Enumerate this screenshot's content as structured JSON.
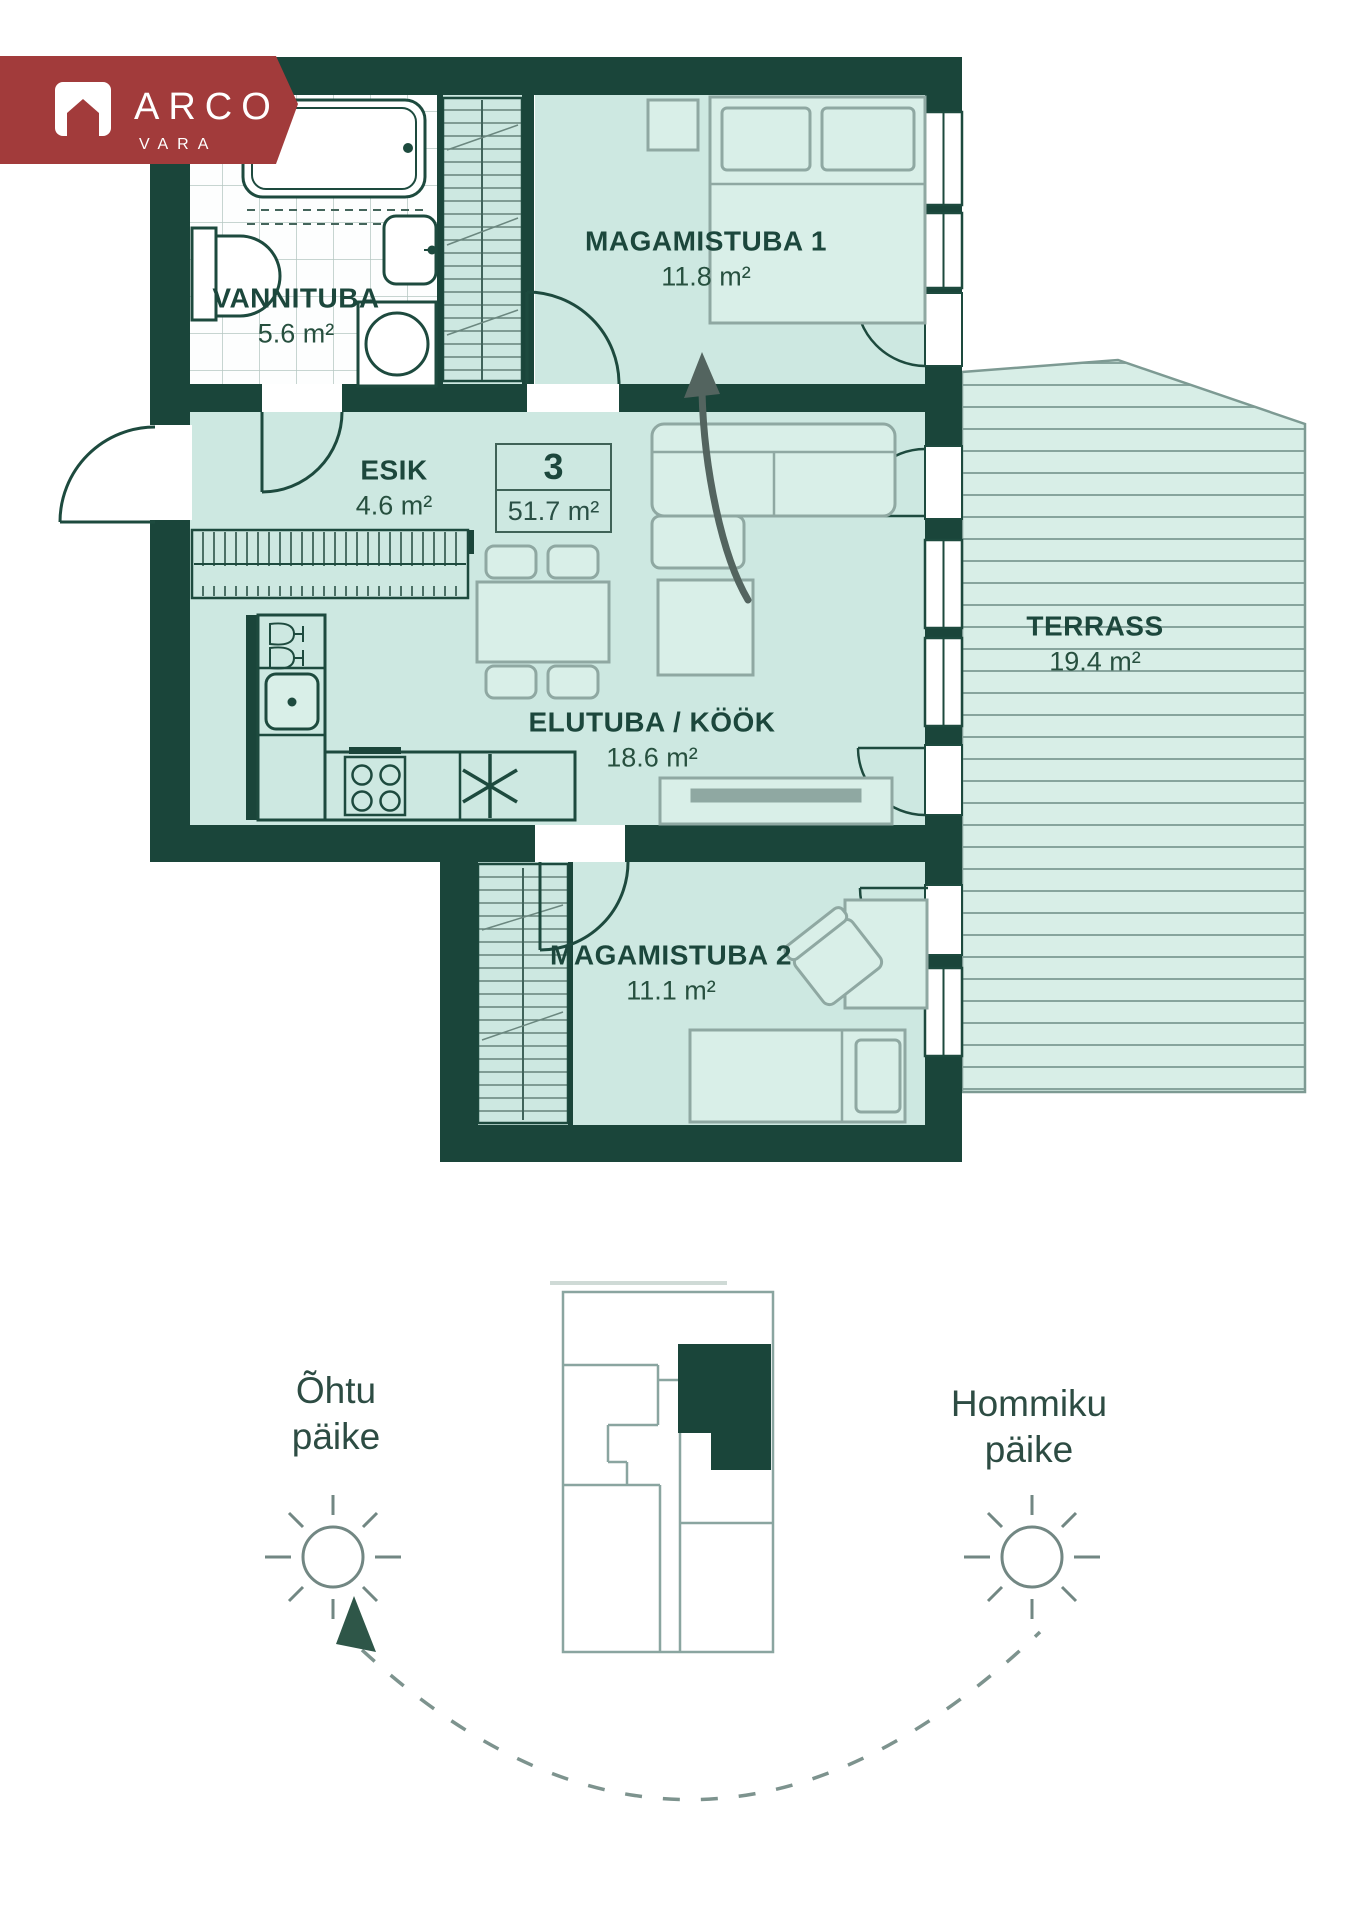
{
  "logo": {
    "brand": "ARCO",
    "sub": "VARA"
  },
  "plan": {
    "unit": {
      "number": "3",
      "area": "51.7 m²"
    },
    "rooms": [
      {
        "id": "vannituba",
        "label": "VANNITUBA",
        "area": "5.6 m²"
      },
      {
        "id": "magamistuba1",
        "label": "MAGAMISTUBA 1",
        "area": "11.8 m²"
      },
      {
        "id": "esik",
        "label": "ESIK",
        "area": "4.6 m²"
      },
      {
        "id": "elutuba_kook",
        "label": "ELUTUBA / KÖÖK",
        "area": "18.6 m²"
      },
      {
        "id": "terrass",
        "label": "TERRASS",
        "area": "19.4 m²"
      },
      {
        "id": "magamistuba2",
        "label": "MAGAMISTUBA 2",
        "area": "11.1 m²"
      }
    ]
  },
  "orientation": {
    "west": {
      "line1": "Õhtu",
      "line2": "päike"
    },
    "east": {
      "line1": "Hommiku",
      "line2": "päike"
    }
  },
  "icons": {
    "logo_house": "house-icon",
    "west_sun": "sun-icon",
    "east_sun": "sun-icon",
    "direction_arrow": "up-arrow-icon",
    "rotation_path": "dashed-arc-with-arrowhead"
  },
  "colors": {
    "wall": "#1a453a",
    "floor_mint": "#cde8e1",
    "terrace_mint": "#d8eee7",
    "furniture_outline": "#8fa8a2",
    "text_green": "#1c473c",
    "banner_red": "#a23b3b",
    "diagram_grey": "#8aa5a0"
  }
}
